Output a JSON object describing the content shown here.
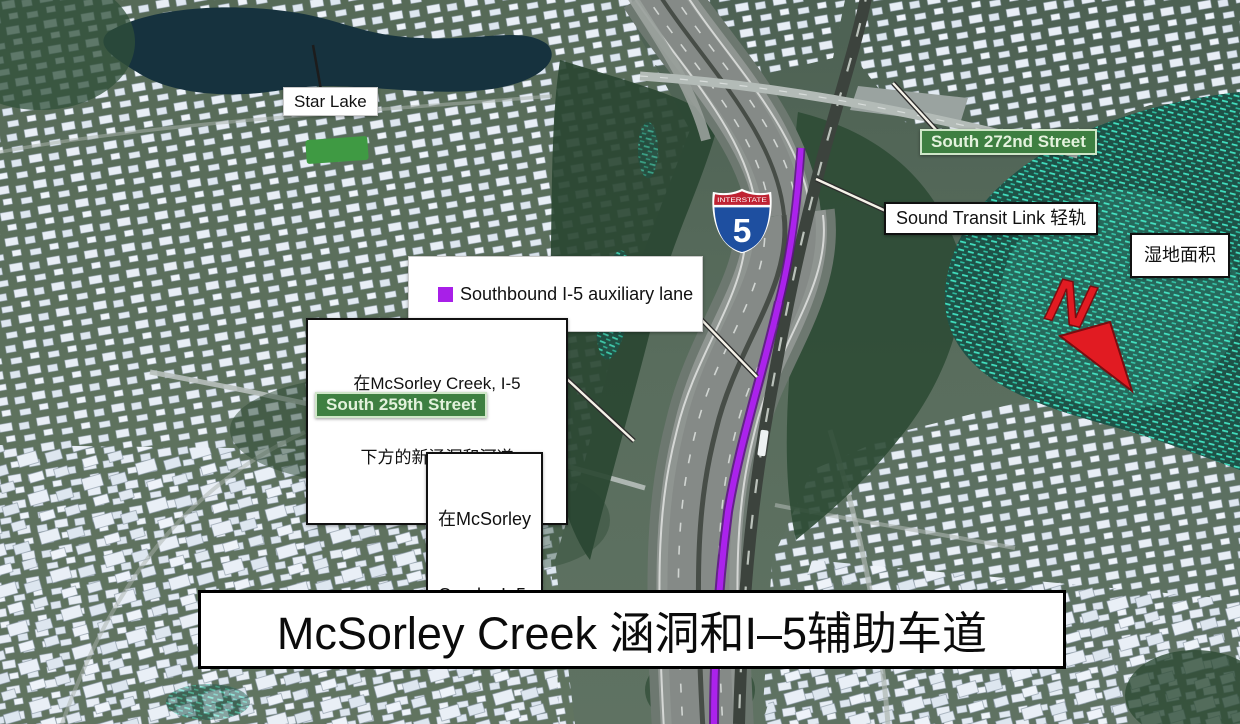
{
  "scene": {
    "title_banner": "McSorley Creek 涵洞和I–5辅助车道",
    "compass": {
      "letter": "N"
    },
    "i5_shield": {
      "top": "INTERSTATE",
      "number": "5"
    },
    "labels": {
      "star_lake": {
        "text": "Star Lake"
      },
      "south_272nd": {
        "text": "South 272nd Street"
      },
      "sound_transit": {
        "text": "Sound Transit Link 轻轨"
      },
      "wetland_area": {
        "text": "湿地面积"
      },
      "aux_lane": {
        "text": "Southbound I-5 auxiliary lane"
      },
      "culvert_note": {
        "line1": "在McSorley Creek, I-5",
        "line2": "下方的新涵洞和河道"
      },
      "south_259th": {
        "text": "South 259th Street"
      },
      "mcsorley_creek": {
        "line1": "在McSorley",
        "line2": "Creek,  I–5"
      }
    },
    "colors": {
      "aux_lane_purple": "#a81fe8",
      "street_sign_green": "#3e7f41",
      "wetland_teal": "#43e6c5",
      "north_arrow_red": "#e11b22"
    }
  }
}
